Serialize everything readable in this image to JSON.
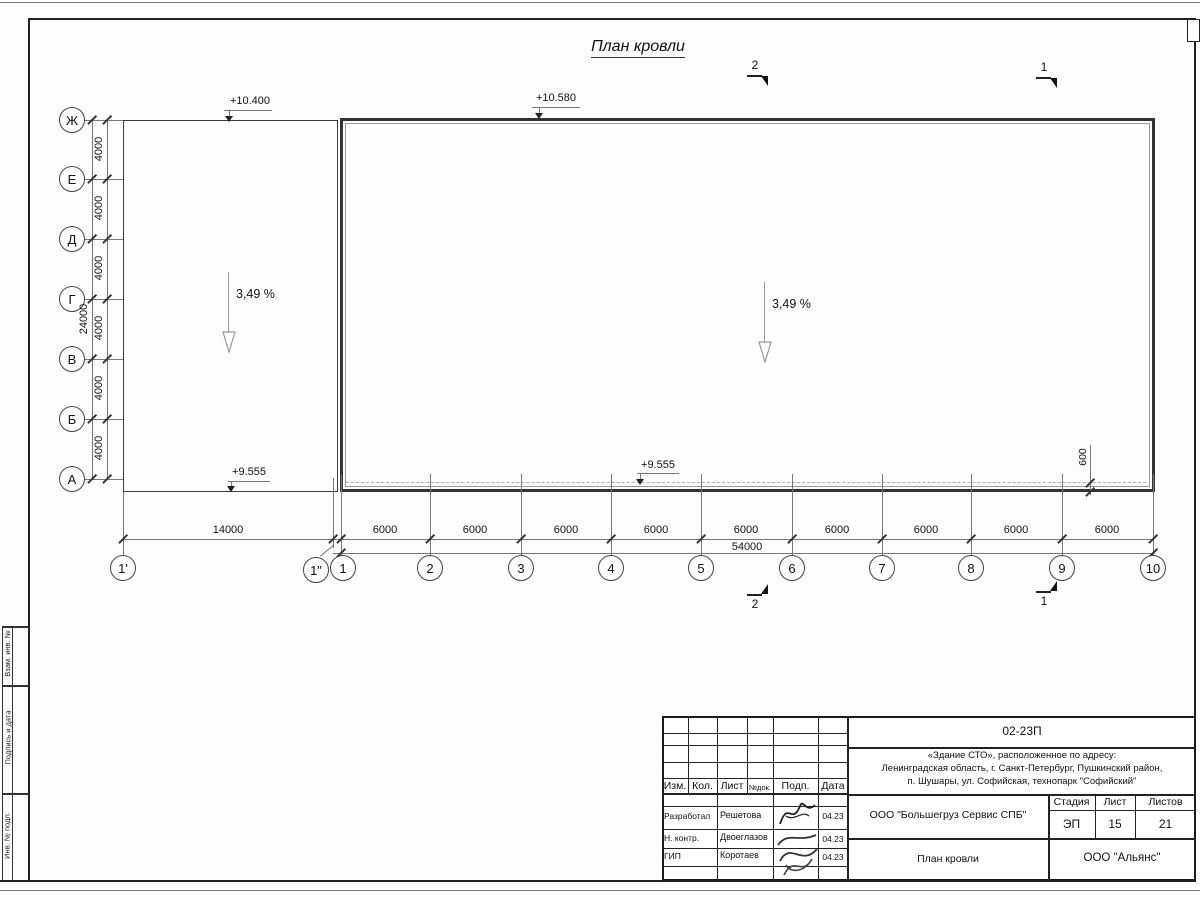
{
  "drawing": {
    "title": "План кровли",
    "elevation_left_top": "+10.400",
    "elevation_right_top": "+10.580",
    "elevation_left_bottom": "+9.555",
    "elevation_right_bottom": "+9.555",
    "slope_left": "3,49 %",
    "slope_right": "3,49 %",
    "offset_dim": "600"
  },
  "axes": {
    "letters": [
      "Ж",
      "Е",
      "Д",
      "Г",
      "В",
      "Б",
      "А"
    ],
    "numbers": [
      "1'",
      "1\"",
      "1",
      "2",
      "3",
      "4",
      "5",
      "6",
      "7",
      "8",
      "9",
      "10"
    ]
  },
  "dims": {
    "v_steps": [
      "4000",
      "4000",
      "4000",
      "4000",
      "4000",
      "4000"
    ],
    "v_total": "24000",
    "h_first": "14000",
    "h_steps": [
      "6000",
      "6000",
      "6000",
      "6000",
      "6000",
      "6000",
      "6000",
      "6000",
      "6000"
    ],
    "h_total": "54000"
  },
  "sections": {
    "top": [
      "2",
      "1"
    ],
    "bottom": [
      "2",
      "1"
    ]
  },
  "frame_strip": {
    "labels": [
      "Взам. инв. №",
      "Подпись и дата",
      "Инв. № подл."
    ]
  },
  "title_block": {
    "code": "02-23П",
    "project_line1": "«Здание СТО», расположенное по адресу:",
    "project_line2": "Ленинградская область, г. Санкт-Петербург, Пушкинский район,",
    "project_line3": "п. Шушары, ул. Софийская, технопарк \"Софийский\"",
    "col_izm": "Изм.",
    "col_kol": "Кол.",
    "col_list": "Лист",
    "col_ndok": "№док.",
    "col_podp": "Подп.",
    "col_data": "Дата",
    "rows": [
      {
        "role": "Разработал",
        "name": "Решетова",
        "date": "04.23"
      },
      {
        "role": "Н. контр.",
        "name": "Двоеглазов",
        "date": "04.23"
      },
      {
        "role": "ГИП",
        "name": "Коротаев",
        "date": "04.23"
      }
    ],
    "company": "ООО \"Большегруз Сервис СПБ\"",
    "stage_label": "Стадия",
    "sheet_label": "Лист",
    "sheets_label": "Листов",
    "stage": "ЭП",
    "sheet": "15",
    "sheets": "21",
    "sheet_title": "План кровли",
    "org": "ООО \"Альянс\""
  }
}
